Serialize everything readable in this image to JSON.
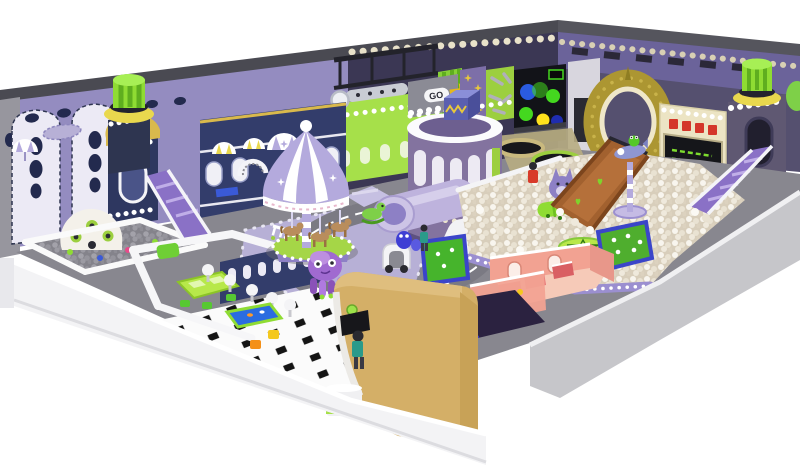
{
  "scene": {
    "title": "Indoor playground - purple and green space theme",
    "view": "isometric 3D render of a kids indoor play center"
  },
  "signs": {
    "go": "GO"
  },
  "palette": {
    "background": "#ffffff",
    "roof_beam": "#4a4a52",
    "wall_lavender": "#948cc0",
    "wall_dark": "#3b3754",
    "wall_purple_band": "#55506f",
    "navy_building": "#333d6b",
    "castle_navy": "#2e3760",
    "dome_gold": "#d9b94c",
    "cupcake_green": "#8fdc33",
    "cupcake_yellow": "#e9d84e",
    "carousel_canopy": "#b4aadd",
    "carousel_base": "#a5d647",
    "floor_gray": "#88878f",
    "road_gray": "#7b7a83",
    "mat_purple": "#b7b0d6",
    "tower_purple": "#83739f",
    "tube_lavender": "#beb3dd",
    "slide_brown": "#a2612f",
    "slide_purple": "#8a71c6",
    "gold_arch": "#ac9632",
    "trampoline_mat": "#17171b",
    "projection_black": "#121318",
    "canopy_tan": "#d4af67",
    "house_pink": "#f2a292",
    "flower_panel_green": "#4fae2e",
    "outer_wall_white": "#f3f3f5",
    "outer_wall_gray": "#c6c6ca",
    "ball_cream": "#efe9dc",
    "ball_pit_gray": "#84838b",
    "octopus_purple": "#a06ad0",
    "go_arrow_yellow": "#e4b81e",
    "accent_lime": "#a6e04a"
  },
  "equipment": [
    {
      "id": "carousel",
      "label": "Carousel"
    },
    {
      "id": "tube-play-tower",
      "label": "Round tube play tower"
    },
    {
      "id": "crawl-tube",
      "label": "Crawl tube"
    },
    {
      "id": "wave-slide",
      "label": "Wave slide through gold arch"
    },
    {
      "id": "ball-pit-right",
      "label": "White ball pit"
    },
    {
      "id": "ball-pit-left",
      "label": "Gray ball pit with dome climber"
    },
    {
      "id": "trampolines",
      "label": "Trampolines"
    },
    {
      "id": "projection-wall",
      "label": "Interactive ball projection wall"
    },
    {
      "id": "plane-spinner",
      "label": "Plane spinner"
    },
    {
      "id": "right-slide",
      "label": "Purple tower slide"
    },
    {
      "id": "castle-slide",
      "label": "Castle slide"
    },
    {
      "id": "toddler-tables",
      "label": "Toddler table area"
    },
    {
      "id": "water-table",
      "label": "Sand and water table"
    },
    {
      "id": "pink-playhouse",
      "label": "Pink playhouse"
    },
    {
      "id": "flower-panel",
      "label": "Flower play panel"
    },
    {
      "id": "spinning-disc",
      "label": "Spinning disc"
    },
    {
      "id": "service-canopy",
      "label": "Tan service canopy"
    },
    {
      "id": "octopus",
      "label": "Octopus mascot"
    },
    {
      "id": "toy-car",
      "label": "Toy car"
    },
    {
      "id": "rocking-dino",
      "label": "Rocking dino"
    },
    {
      "id": "cupcake-towers",
      "label": "Green cupcake towers"
    }
  ]
}
